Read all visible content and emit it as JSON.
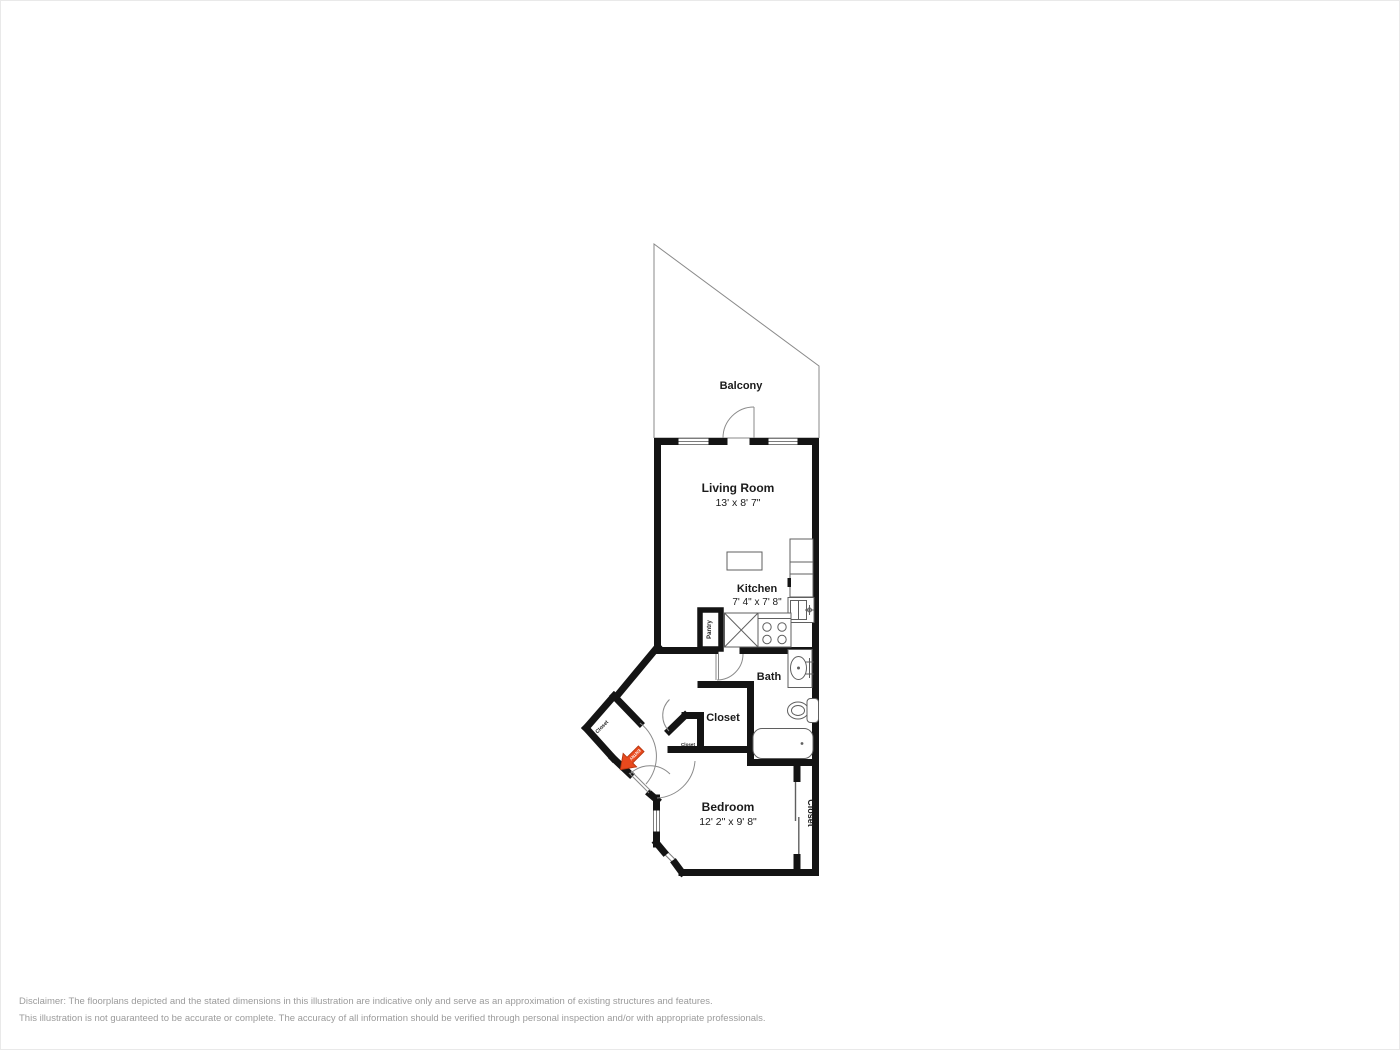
{
  "rooms": {
    "balcony": {
      "label": "Balcony"
    },
    "living_room": {
      "label": "Living Room",
      "dims": "13' x 8' 7\""
    },
    "kitchen": {
      "label": "Kitchen",
      "dims": "7' 4\" x 7' 8\""
    },
    "bath": {
      "label": "Bath"
    },
    "hall_closet": {
      "label": "Closet"
    },
    "bedroom": {
      "label": "Bedroom",
      "dims": "12' 2\" x 9' 8\""
    },
    "bedroom_closet": {
      "label": "Closet"
    },
    "pantry": {
      "label": "Pantry"
    },
    "entry_closet": {
      "label": "Closet"
    },
    "coat_closet": {
      "label": "Closet"
    }
  },
  "entry": {
    "label": "ENTRY"
  },
  "colors": {
    "wall": "#141414",
    "fixture_line": "#5f5f5f",
    "thin_line": "#8a8a8a",
    "entry_arrow": "#e8491d",
    "disclaimer_text": "#9b9b9b"
  },
  "disclaimer": {
    "line1": "Disclaimer: The floorplans depicted and the stated dimensions in this illustration are indicative only and serve as an approximation of existing structures and features.",
    "line2": "This illustration is not guaranteed to be accurate or complete. The accuracy of all information should be verified through personal inspection and/or with appropriate professionals."
  }
}
